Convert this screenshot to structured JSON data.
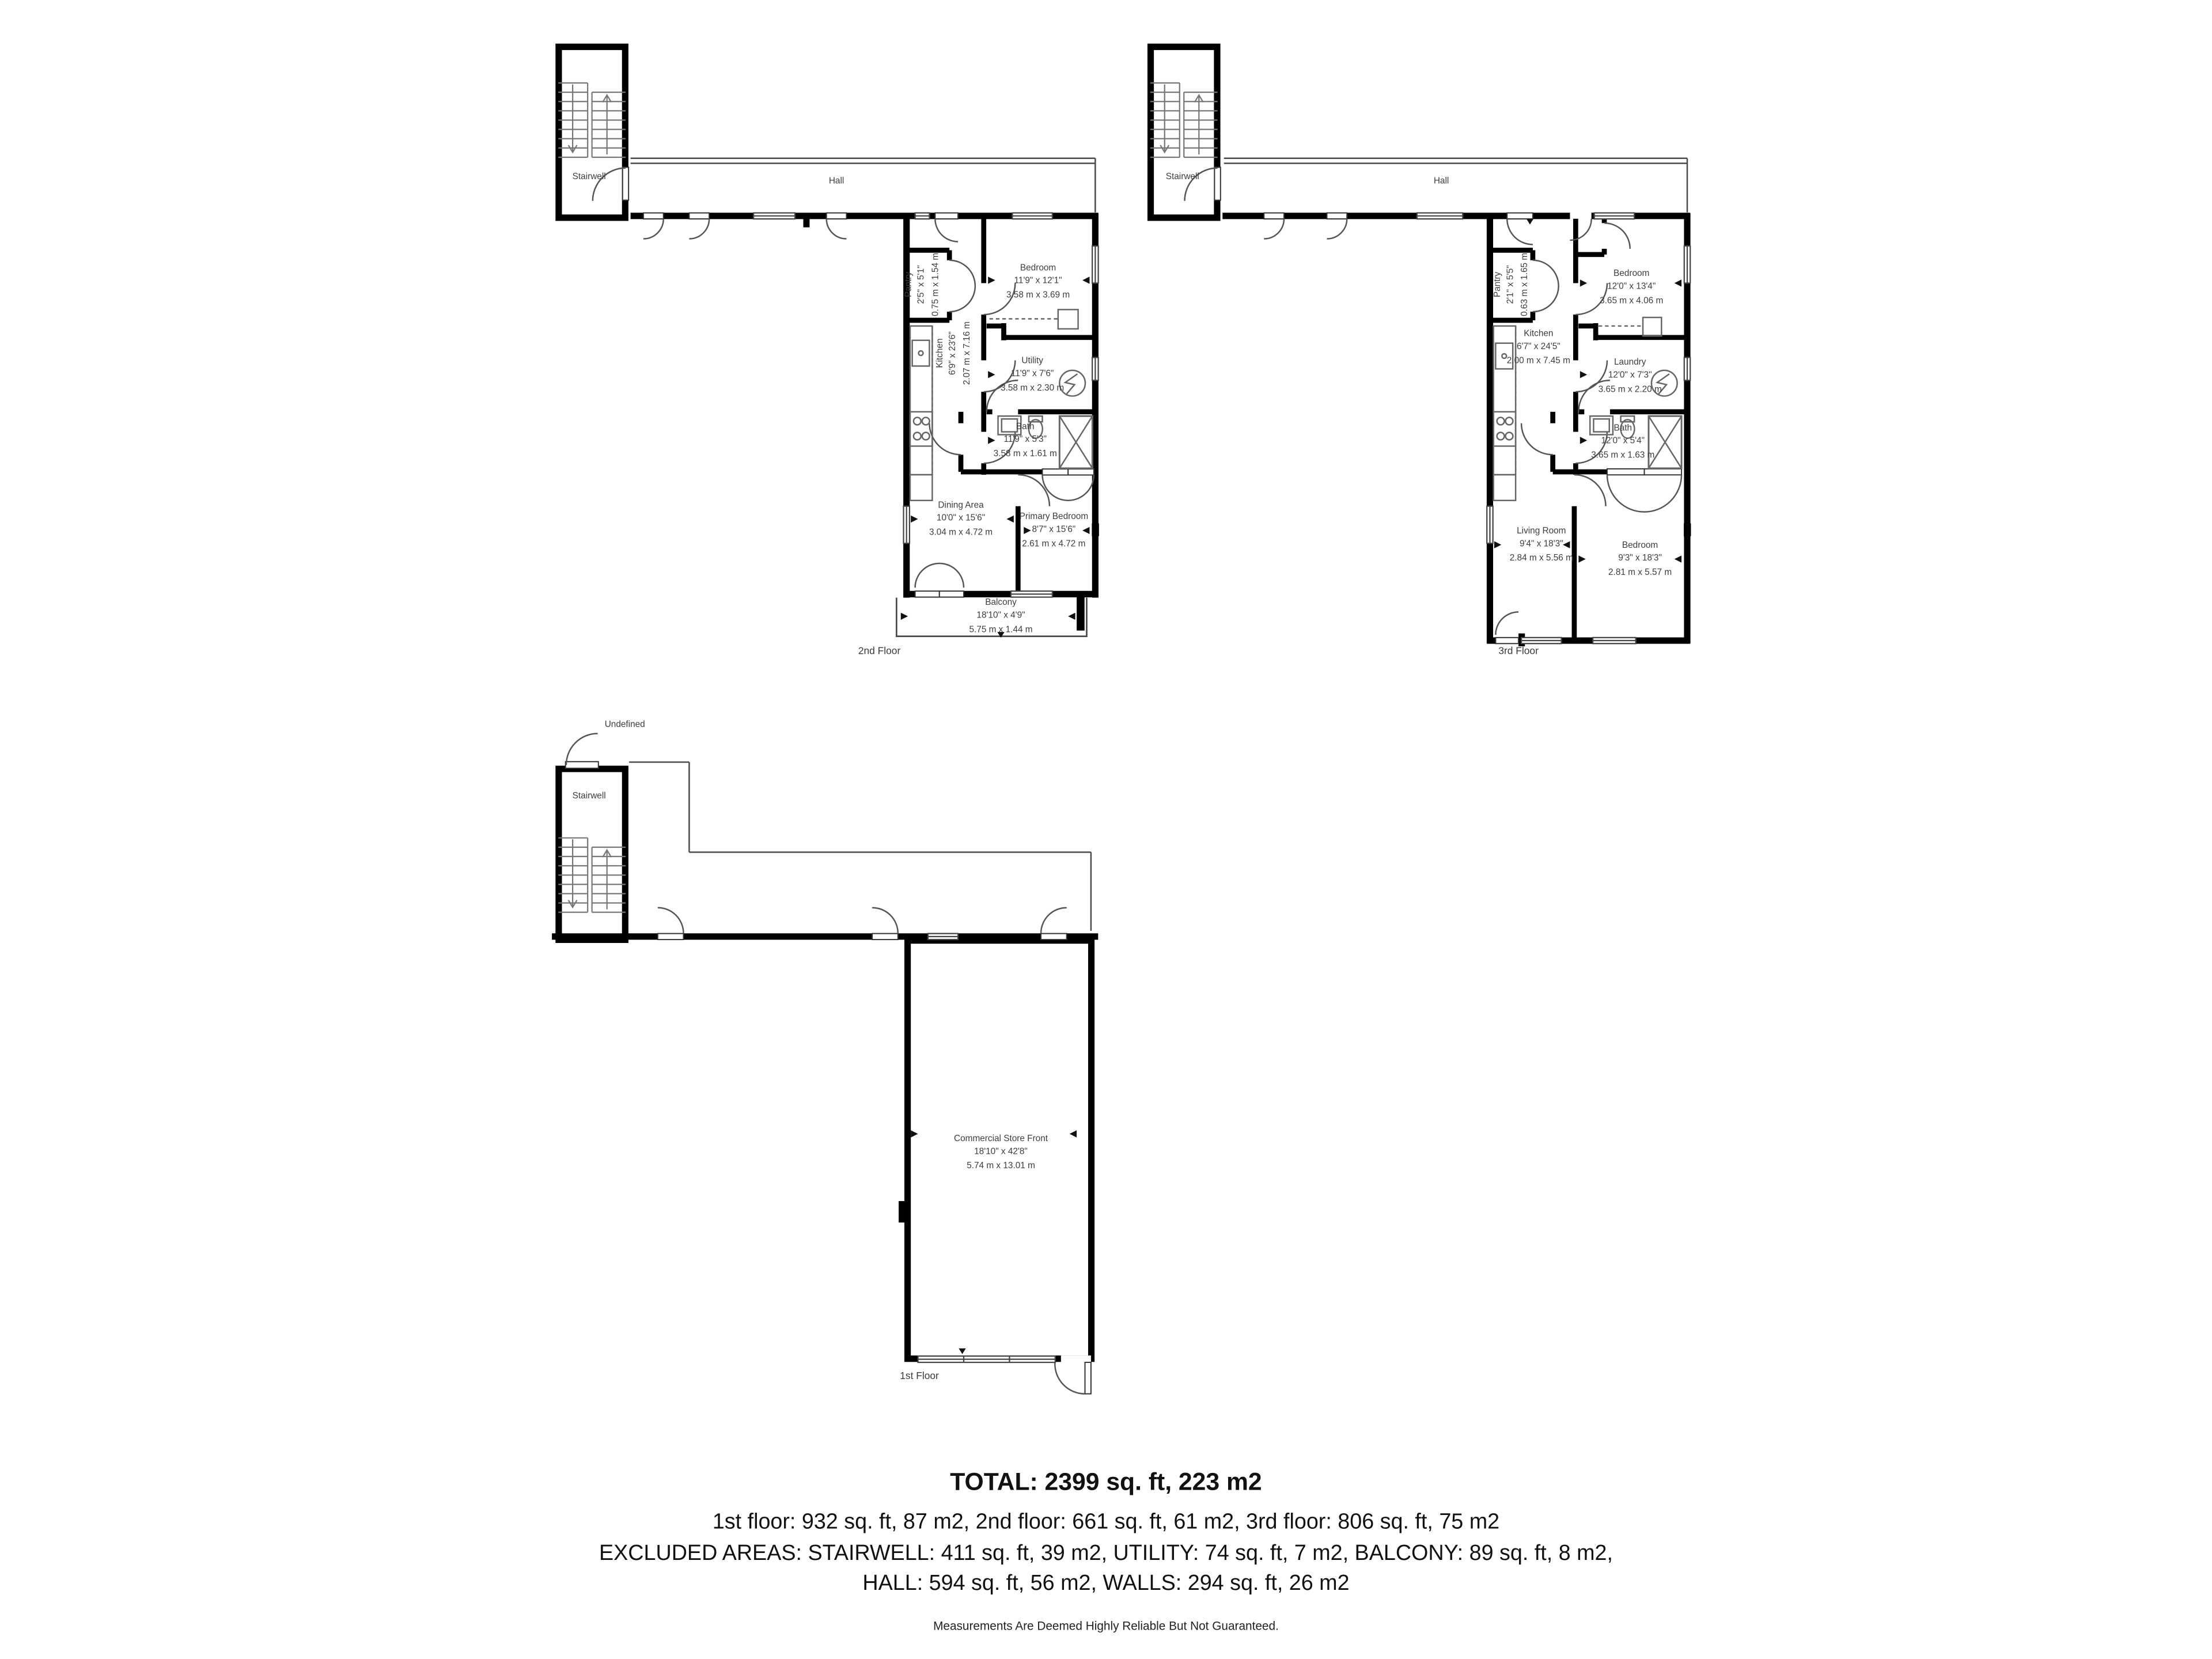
{
  "colors": {
    "wall": "#000000",
    "thin_line": "#4a4a4a",
    "fixture_line": "#666666",
    "room_label": "#3d3d3d",
    "summary_text": "#111111"
  },
  "floors": {
    "f2": {
      "caption": "2nd Floor",
      "stairwell": "Stairwell",
      "hall": "Hall",
      "rooms": {
        "pantry": {
          "name": "Pantry",
          "imp": "2'5\" x 5'1\"",
          "met": "0.75 m x 1.54 m"
        },
        "kitchen": {
          "name": "Kitchen",
          "imp": "6'9\" x 23'6\"",
          "met": "2.07 m x 7.16 m"
        },
        "bedroom": {
          "name": "Bedroom",
          "imp": "11'9\" x 12'1\"",
          "met": "3.58 m x 3.69 m"
        },
        "utility": {
          "name": "Utility",
          "imp": "11'9\" x 7'6\"",
          "met": "3.58 m x 2.30 m"
        },
        "bath": {
          "name": "Bath",
          "imp": "11'9\" x 5'3\"",
          "met": "3.58 m x 1.61 m"
        },
        "dining": {
          "name": "Dining Area",
          "imp": "10'0\" x 15'6\"",
          "met": "3.04 m x 4.72 m"
        },
        "primary": {
          "name": "Primary Bedroom",
          "imp": "8'7\" x 15'6\"",
          "met": "2.61 m x 4.72 m"
        },
        "balcony": {
          "name": "Balcony",
          "imp": "18'10\" x 4'9\"",
          "met": "5.75 m x 1.44 m"
        }
      }
    },
    "f3": {
      "caption": "3rd Floor",
      "stairwell": "Stairwell",
      "hall": "Hall",
      "rooms": {
        "pantry": {
          "name": "Pantry",
          "imp": "2'1\" x 5'5\"",
          "met": "0.63 m x 1.65 m"
        },
        "kitchen": {
          "name": "Kitchen",
          "imp": "6'7\" x 24'5\"",
          "met": "2.00 m x 7.45 m"
        },
        "bedroom": {
          "name": "Bedroom",
          "imp": "12'0\" x 13'4\"",
          "met": "3.65 m x 4.06 m"
        },
        "laundry": {
          "name": "Laundry",
          "imp": "12'0\" x 7'3\"",
          "met": "3.65 m x 2.20 m"
        },
        "bath": {
          "name": "Bath",
          "imp": "12'0\" x 5'4\"",
          "met": "3.65 m x 1.63 m"
        },
        "living": {
          "name": "Living Room",
          "imp": "9'4\" x 18'3\"",
          "met": "2.84 m x 5.56 m"
        },
        "bedroom2": {
          "name": "Bedroom",
          "imp": "9'3\" x 18'3\"",
          "met": "2.81 m x 5.57 m"
        }
      }
    },
    "f1": {
      "caption": "1st Floor",
      "stairwell": "Stairwell",
      "undefined_label": "Undefined",
      "rooms": {
        "store": {
          "name": "Commercial Store Front",
          "imp": "18'10\" x 42'8\"",
          "met": "5.74 m x 13.01 m"
        }
      }
    }
  },
  "summary": {
    "total": "TOTAL: 2399 sq. ft, 223 m2",
    "floors_line": "1st floor: 932 sq. ft, 87 m2, 2nd floor: 661 sq. ft, 61 m2, 3rd floor: 806 sq. ft, 75 m2",
    "excluded_line1": "EXCLUDED AREAS: STAIRWELL: 411 sq. ft, 39 m2, UTILITY: 74 sq. ft, 7 m2, BALCONY: 89 sq. ft, 8 m2,",
    "excluded_line2": "HALL: 594 sq. ft, 56 m2, WALLS: 294 sq. ft, 26 m2",
    "disclaimer": "Measurements Are Deemed Highly Reliable But Not Guaranteed."
  }
}
